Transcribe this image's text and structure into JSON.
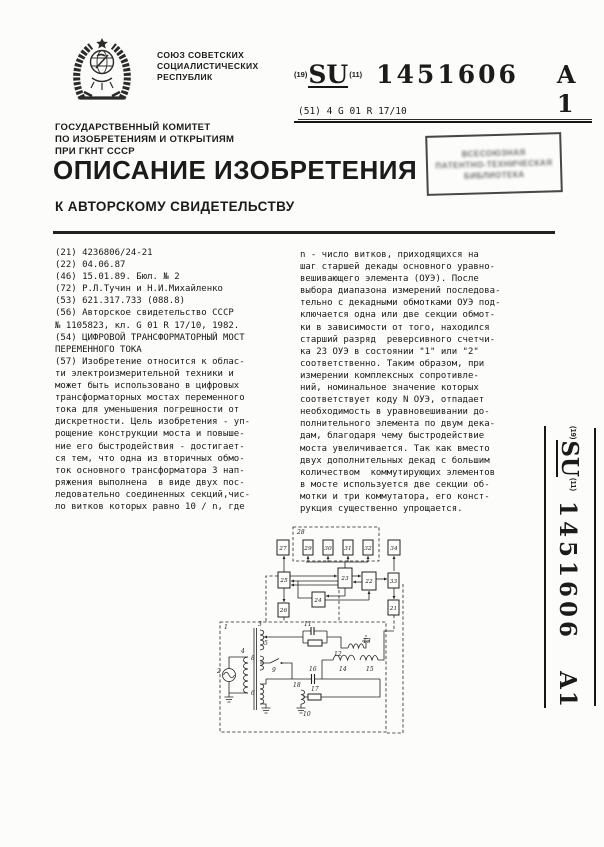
{
  "publication": {
    "country_lines": [
      "СОЮЗ СОВЕТСКИХ",
      "СОЦИАЛИСТИЧЕСКИХ",
      "РЕСПУБЛИК"
    ],
    "inid_19": "(19)",
    "code": "SU",
    "inid_11": "(11)",
    "number": "1451606",
    "kind": "A 1",
    "ipc_prefix": "(51) 4 ",
    "ipc": "G 01 R 17/10"
  },
  "committee_lines": [
    "ГОСУДАРСТВЕННЫЙ КОМИТЕТ",
    "ПО ИЗОБРЕТЕНИЯМ И ОТКРЫТИЯМ",
    "ПРИ ГКНТ СССР"
  ],
  "title": "ОПИСАНИЕ ИЗОБРЕТЕНИЯ",
  "subtitle": "К АВТОРСКОМУ СВИДЕТЕЛЬСТВУ",
  "stamp_lines": [
    "ВСЕСОЮЗНАЯ",
    "ПАТЕНТНО-ТЕХНИЧЕСКАЯ",
    "БИБЛИОТЕКА"
  ],
  "left_column_lines": [
    "(21) 4236806/24-21",
    "(22) 04.06.87",
    "(46) 15.01.89. Бюл. № 2",
    "(72) Р.Л.Тучин и Н.И.Михайленко",
    "(53) 621.317.733 (088.8)",
    "(56) Авторское свидетельство СССР",
    "№ 1105823, кл. G 01 R 17/10, 1982.",
    "(54) ЦИФРОВОЙ ТРАНСФОРМАТОРНЫЙ МОСТ",
    "ПЕРЕМЕННОГО ТОКА",
    "(57) Изобретение относится к облас-",
    "ти электроизмерительной техники и",
    "может быть использовано в цифровых",
    "трансформаторных мостах переменного",
    "тока для уменьшения погрешности от",
    "дискретности. Цель изобретения - уп-",
    "рощение конструкции моста и повыше-",
    "ние его быстродействия - достигает-",
    "ся тем, что одна из вторичных обмо-",
    "ток основного трансформатора 3 нап-",
    "ряжения выполнена  в виде двух пос-",
    "ледовательно соединенных секций,чис-",
    "ло витков которых равно 10 / n, где"
  ],
  "right_column_lines": [
    "n - число витков, приходящихся на",
    "шаг старшей декады основного уравно-",
    "вешивающего элемента (ОУЭ). После",
    "выбора диапазона измерений последова-",
    "тельно с декадными обмотками ОУЭ под-",
    "ключается одна или две секции обмот-",
    "ки в зависимости от того, находился",
    "старший разряд  реверсивного счетчи-",
    "ка 23 ОУЭ в состоянии \"1\" или \"2\"",
    "соответственно. Таким образом, при",
    "измерении комплексных сопротивле-",
    "ний, номинальное значение которых",
    "соответствует коду N ОУЭ, отпадает",
    "необходимость в уравновешивании до-",
    "полнительного элемента по двум дека-",
    "дам, благодаря чему быстродействие",
    "моста увеличивается. Так как вместо",
    "двух дополнительных декад с большим",
    "количеством  коммутирующих элементов",
    "в мосте используется две секции об-",
    "мотки и три коммутатора, его конст-",
    "рукция существенно упрощается."
  ],
  "side_label": {
    "inid_19": "(19)",
    "code": "SU",
    "inid_11": "(11)",
    "number": "1451606",
    "kind": "A1"
  },
  "diagram": {
    "labels": {
      "1": "1",
      "2": "2",
      "3": "3",
      "4": "4",
      "5": "5",
      "6": "6",
      "8": "8",
      "9": "9",
      "10": "10",
      "11": "11",
      "12": "12",
      "13": "13",
      "14": "14",
      "15": "15",
      "16": "16",
      "17": "17",
      "18": "18",
      "21": "21",
      "22": "22",
      "23": "23",
      "24": "24",
      "25": "25",
      "26": "26",
      "27": "27",
      "28": "28",
      "29": "29",
      "30": "30",
      "31": "31",
      "32": "32",
      "33": "33",
      "34": "34"
    }
  }
}
